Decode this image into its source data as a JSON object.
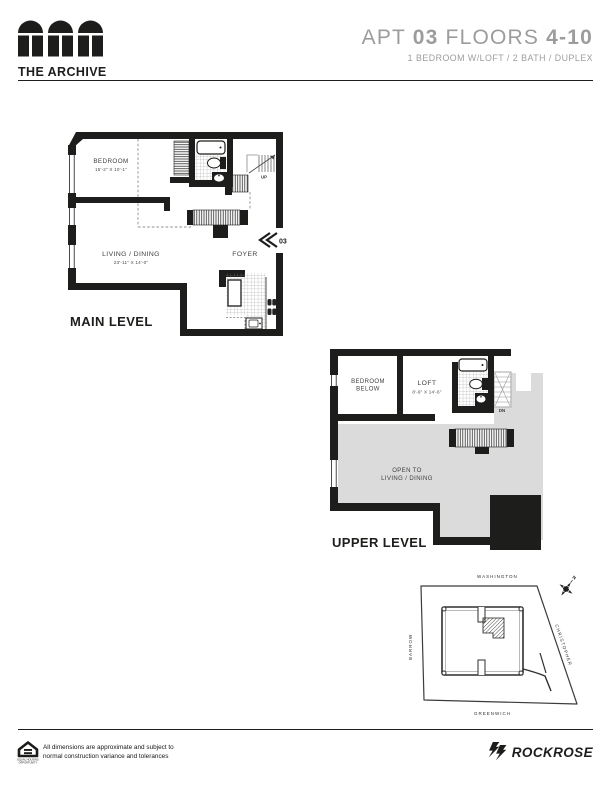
{
  "colors": {
    "wall": "#1d1d1b",
    "title_gray": "#9c9c9c",
    "open_area_gray": "#dbdbdb",
    "label": "#3f3f3e"
  },
  "header": {
    "logo_text": "THE ARCHIVE",
    "title": {
      "apt_label": "APT",
      "apt_number": "03",
      "floors_label": "FLOORS",
      "floors_range": "4-10"
    },
    "subtitle": "1 BEDROOM W/LOFT / 2 BATH / DUPLEX"
  },
  "main_level": {
    "label": "MAIN LEVEL",
    "bedroom_name": "BEDROOM",
    "bedroom_dims": "15'-2\" X 10'-1\"",
    "living_name": "LIVING / DINING",
    "living_dims": "23'-11\" X 14'-0\"",
    "foyer_name": "FOYER",
    "stair_label": "UP",
    "unit_number": "03"
  },
  "upper_level": {
    "label": "UPPER LEVEL",
    "bedroom_below_line1": "BEDROOM",
    "bedroom_below_line2": "BELOW",
    "loft_name": "LOFT",
    "loft_dims": "8'-9\" X 14'-6\"",
    "open_line1": "OPEN TO",
    "open_line2": "LIVING / DINING",
    "stair_label": "DN"
  },
  "site_map": {
    "street_top": "WASHINGTON",
    "street_left": "BARROW",
    "street_right": "CHRISTOPHER",
    "street_bottom": "GREENWICH",
    "compass_label": "N"
  },
  "footer": {
    "disclaimer_line1": "All dimensions are approximate and subject to",
    "disclaimer_line2": "normal construction variance and tolerances",
    "eho_line1": "EQUAL HOUSING",
    "eho_line2": "OPPORTUNITY",
    "brand": "ROCKROSE"
  }
}
